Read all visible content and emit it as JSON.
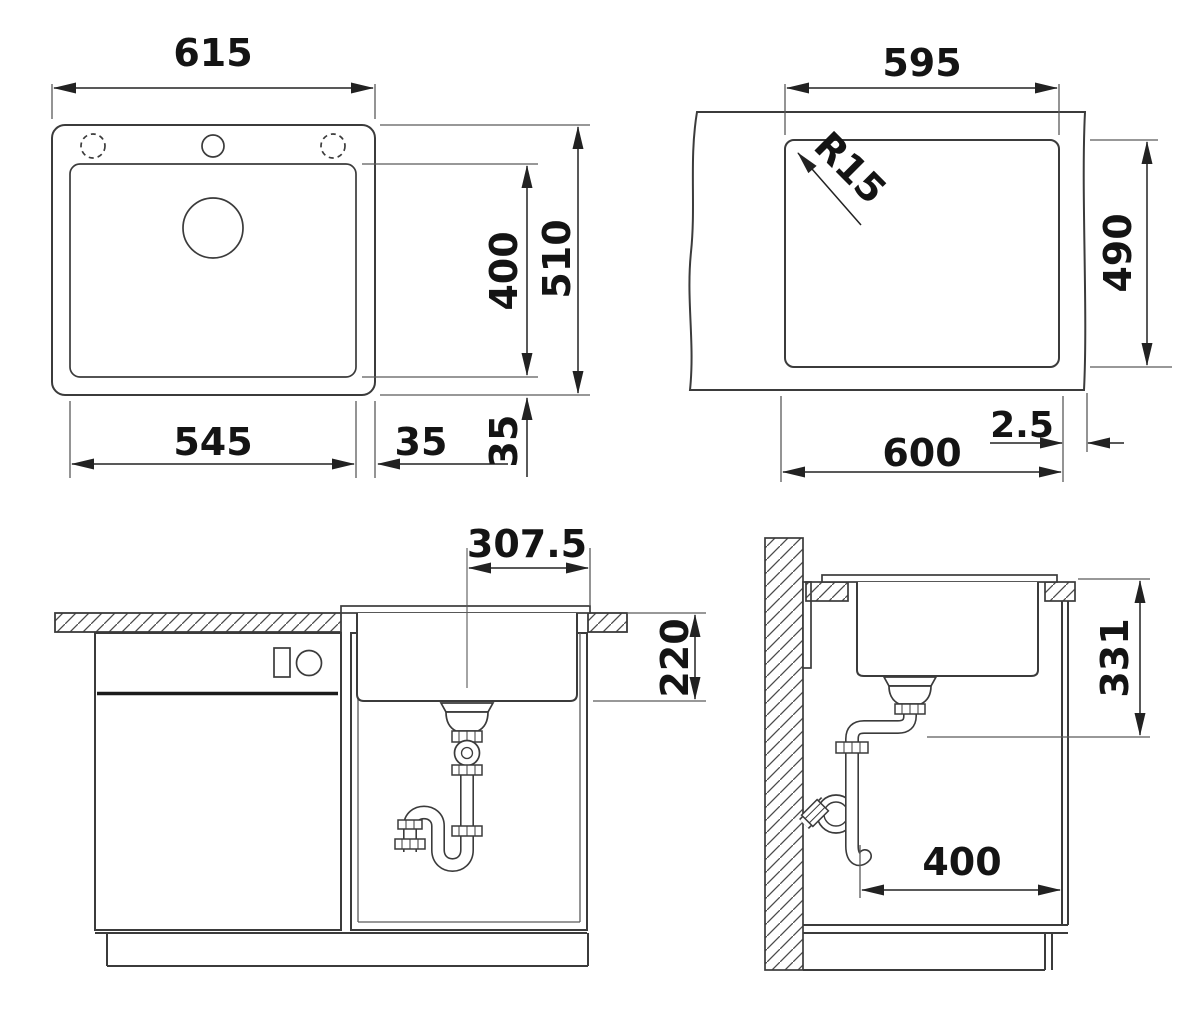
{
  "document": {
    "type": "technical-drawing",
    "subject": "kitchen sink installation drawing with four dimensioned views"
  },
  "colors": {
    "line": "#3b3b3b",
    "text": "#141414",
    "background": "#ffffff"
  },
  "views": {
    "top": {
      "label": "sink-top-view",
      "dimensions": {
        "overall_width": "615",
        "bowl_depth": "400",
        "overall_depth": "510",
        "bowl_width": "545",
        "right_rim": "35",
        "bottom_rim": "35"
      }
    },
    "cutout": {
      "label": "worktop-cutout-view",
      "dimensions": {
        "cutout_width": "595",
        "corner_radius": "R15",
        "cutout_depth": "490",
        "cabinet_width": "600",
        "edge_distance": "2.5"
      }
    },
    "front": {
      "label": "front-section-view",
      "dimensions": {
        "drain_center_offset": "307.5",
        "bowl_inner_depth": "220"
      }
    },
    "side": {
      "label": "side-section-view",
      "dimensions": {
        "outlet_height": "331",
        "outlet_wall_distance": "400"
      }
    }
  }
}
